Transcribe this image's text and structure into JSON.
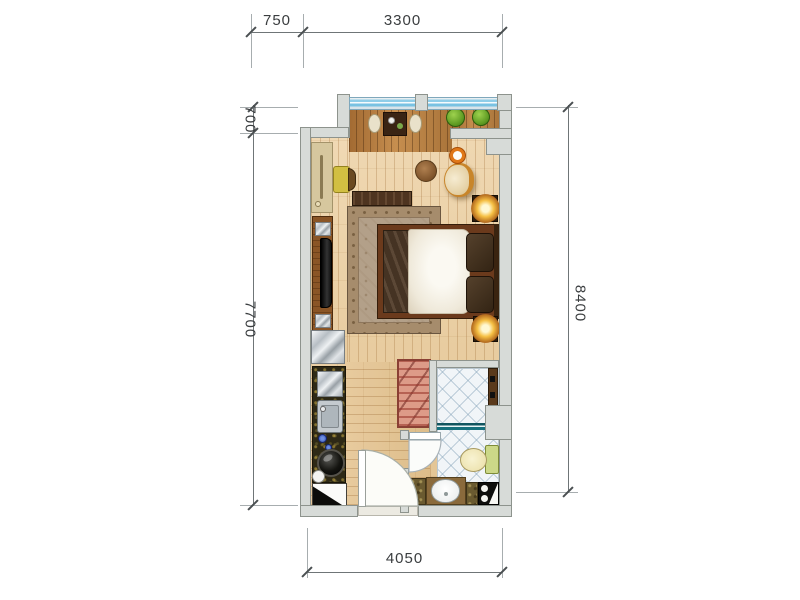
{
  "figure": {
    "type": "apartment-floor-plan",
    "units": "mm",
    "rooms": [
      "balcony",
      "bedroom-living",
      "kitchenette",
      "hallway",
      "bathroom"
    ],
    "furniture": [
      "dining-table",
      "stools",
      "plants",
      "desk",
      "chair",
      "tv-cabinet",
      "tv",
      "round-table",
      "armchair",
      "candle-bowl",
      "bench",
      "rug",
      "double-bed",
      "pillows",
      "nightstand-lamps",
      "fridge",
      "kitchen-sink",
      "cooktop",
      "wardrobe",
      "shower",
      "toilet",
      "vanity-sink"
    ]
  },
  "dimensions": {
    "top": {
      "d1": "750",
      "d2": "3300"
    },
    "left": {
      "d1": "700",
      "d2": "7700"
    },
    "right": {
      "d1": "8400"
    },
    "bottom": {
      "d1": "4050"
    }
  },
  "colors": {
    "wall": "#d7dbd8",
    "wall_edge": "#8d938d",
    "floor_wood": "#ecd3ab",
    "deck_wood": "#b07b40",
    "window_glass": "#8fcde8",
    "bathroom_tile": "#f1f5f8",
    "rug": "#b3a089",
    "lamp_glow": "#f6c044",
    "wardrobe_red": "#b85c4c",
    "shower_glass": "#1a6f7c",
    "bed_duvet": "#f2efe6",
    "bed_frame": "#6b3a1c"
  }
}
